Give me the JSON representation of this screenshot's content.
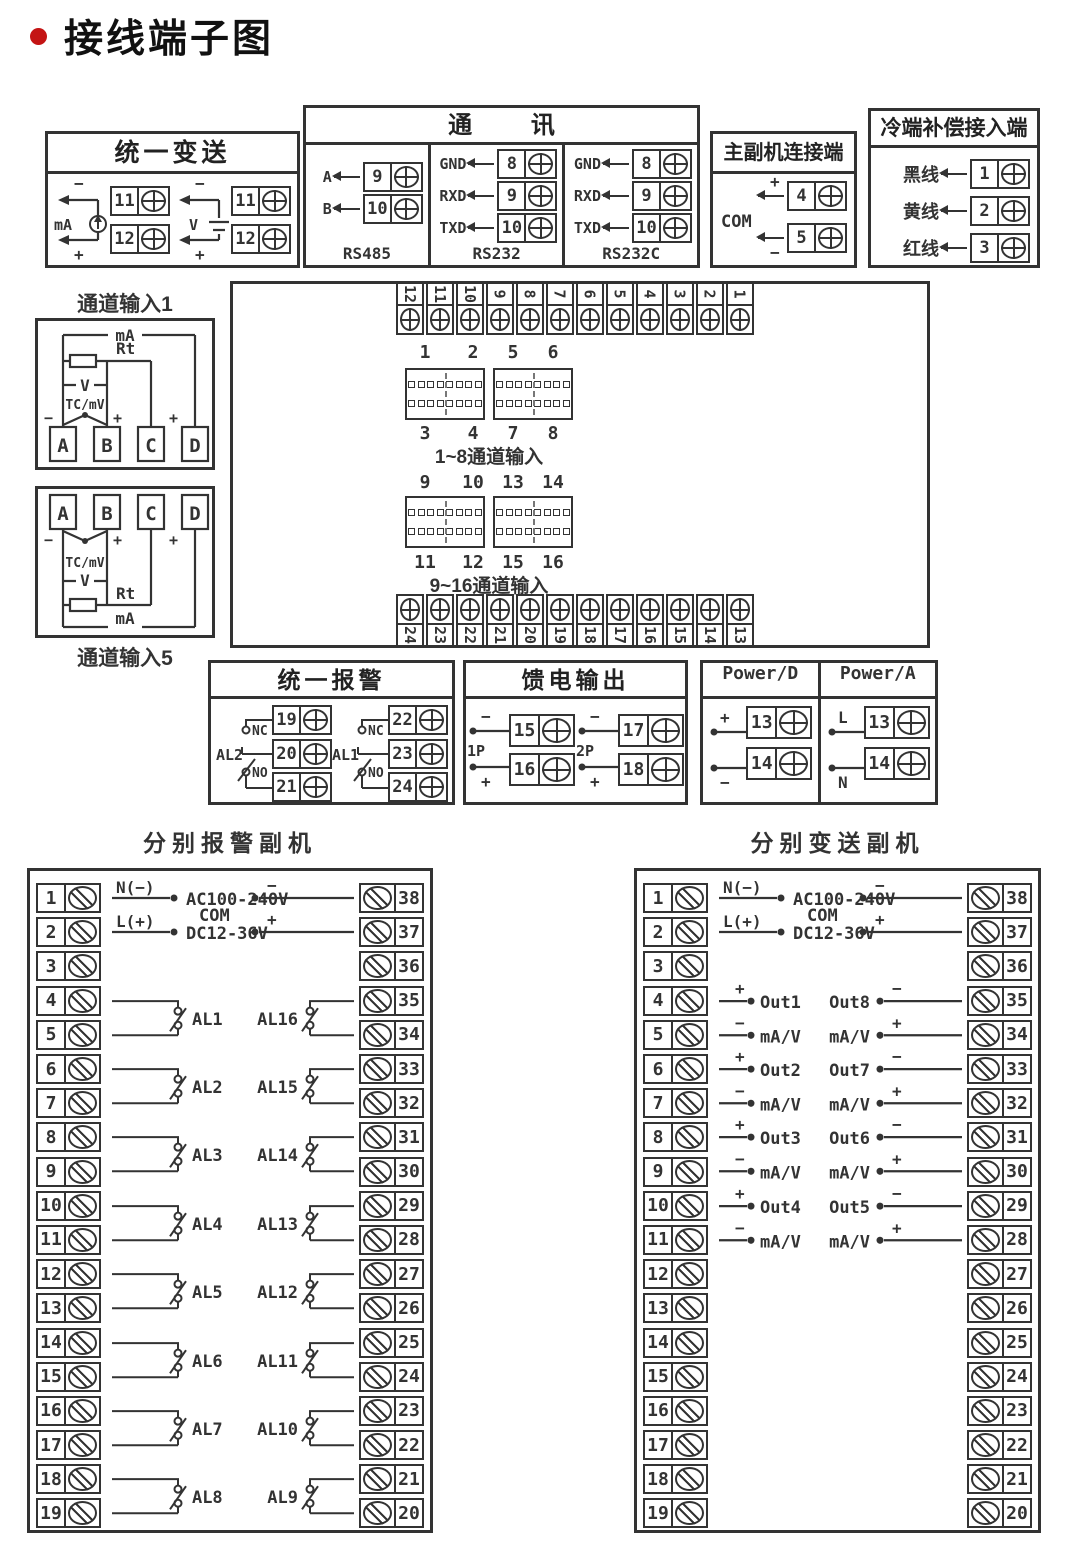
{
  "header": {
    "title": "接线端子图"
  },
  "unified_transmit": {
    "title": "统一变送",
    "groups": [
      {
        "label": "mA",
        "minus": "−",
        "plus": "+",
        "terminals": [
          "11",
          "12"
        ]
      },
      {
        "label": "V",
        "minus": "−",
        "plus": "+",
        "terminals": [
          "11",
          "12"
        ]
      }
    ]
  },
  "comm": {
    "title": "通 讯",
    "columns": [
      {
        "name": "RS485",
        "rows": [
          {
            "label": "A",
            "num": "9"
          },
          {
            "label": "B",
            "num": "10"
          }
        ]
      },
      {
        "name": "RS232",
        "rows": [
          {
            "label": "GND",
            "num": "8"
          },
          {
            "label": "RXD",
            "num": "9"
          },
          {
            "label": "TXD",
            "num": "10"
          }
        ]
      },
      {
        "name": "RS232C",
        "rows": [
          {
            "label": "GND",
            "num": "8"
          },
          {
            "label": "RXD",
            "num": "9"
          },
          {
            "label": "TXD",
            "num": "10"
          }
        ]
      }
    ]
  },
  "master_slave": {
    "title": "主副机连接端",
    "com": "COM",
    "rows": [
      {
        "sign": "+",
        "num": "4"
      },
      {
        "sign": "−",
        "num": "5"
      }
    ]
  },
  "cold_junction": {
    "title": "冷端补偿接入端",
    "rows": [
      {
        "label": "黑线",
        "num": "1"
      },
      {
        "label": "黄线",
        "num": "2"
      },
      {
        "label": "红线",
        "num": "3"
      }
    ]
  },
  "channel_input_1": {
    "title": "通道输入1",
    "ma": "mA",
    "rt": "Rt",
    "v": "V",
    "tc": "TC/mV",
    "minus": "−",
    "plus": "+",
    "terminals": [
      "A",
      "B",
      "C",
      "D"
    ]
  },
  "channel_input_5": {
    "title": "通道输入5",
    "ma": "mA",
    "rt": "Rt",
    "v": "V",
    "tc": "TC/mV",
    "minus": "−",
    "plus": "+",
    "terminals": [
      "A",
      "B",
      "C",
      "D"
    ]
  },
  "main_board": {
    "top_strip": [
      "12",
      "11",
      "10",
      "9",
      "8",
      "7",
      "6",
      "5",
      "4",
      "3",
      "2",
      "1"
    ],
    "bottom_strip": [
      "24",
      "23",
      "22",
      "21",
      "20",
      "19",
      "18",
      "17",
      "16",
      "15",
      "14",
      "13"
    ],
    "group1": {
      "top_labels": [
        "1",
        "2",
        "5",
        "6"
      ],
      "bottom_labels": [
        "3",
        "4",
        "7",
        "8"
      ],
      "caption": "1~8通道输入"
    },
    "group2": {
      "top_labels": [
        "9",
        "10",
        "13",
        "14"
      ],
      "bottom_labels": [
        "11",
        "12",
        "15",
        "16"
      ],
      "caption": "9~16通道输入"
    }
  },
  "unified_alarm": {
    "title": "统一报警",
    "nc": "NC",
    "no": "NO",
    "groups": [
      {
        "name": "AL2",
        "terminals": [
          "19",
          "20",
          "21"
        ]
      },
      {
        "name": "AL1",
        "terminals": [
          "22",
          "23",
          "24"
        ]
      }
    ]
  },
  "feed_output": {
    "title": "馈电输出",
    "minus": "−",
    "plus": "+",
    "groups": [
      {
        "name": "1P",
        "terminals": [
          "15",
          "16"
        ]
      },
      {
        "name": "2P",
        "terminals": [
          "17",
          "18"
        ]
      }
    ]
  },
  "power": {
    "columns": [
      {
        "title": "Power/D",
        "top_sign": "+",
        "bottom_sign": "−",
        "terminals": [
          "13",
          "14"
        ]
      },
      {
        "title": "Power/A",
        "top_sign": "L",
        "bottom_sign": "N",
        "terminals": [
          "13",
          "14"
        ]
      }
    ]
  },
  "alarm_slave": {
    "title": "分别报警副机",
    "power": {
      "n": "N(−)",
      "l": "L(+)",
      "ac": "AC100-240V",
      "dc": "DC12-36V"
    },
    "com": {
      "label": "COM",
      "minus": "−",
      "plus": "+"
    },
    "left_terminals": [
      "1",
      "2",
      "3",
      "4",
      "5",
      "6",
      "7",
      "8",
      "9",
      "10",
      "11",
      "12",
      "13",
      "14",
      "15",
      "16",
      "17",
      "18",
      "19"
    ],
    "right_terminals": [
      "38",
      "37",
      "36",
      "35",
      "34",
      "33",
      "32",
      "31",
      "30",
      "29",
      "28",
      "27",
      "26",
      "25",
      "24",
      "23",
      "22",
      "21",
      "20"
    ],
    "left_relays": [
      "AL1",
      "AL2",
      "AL3",
      "AL4",
      "AL5",
      "AL6",
      "AL7",
      "AL8"
    ],
    "right_relays": [
      "AL16",
      "AL15",
      "AL14",
      "AL13",
      "AL12",
      "AL11",
      "AL10",
      "AL9"
    ]
  },
  "transmit_slave": {
    "title": "分别变送副机",
    "power": {
      "n": "N(−)",
      "l": "L(+)",
      "ac": "AC100-240V",
      "dc": "DC12-36V"
    },
    "com": {
      "label": "COM",
      "minus": "−",
      "plus": "+"
    },
    "plus": "+",
    "minus": "−",
    "left_terminals": [
      "1",
      "2",
      "3",
      "4",
      "5",
      "6",
      "7",
      "8",
      "9",
      "10",
      "11",
      "12",
      "13",
      "14",
      "15",
      "16",
      "17",
      "18",
      "19"
    ],
    "right_terminals": [
      "38",
      "37",
      "36",
      "35",
      "34",
      "33",
      "32",
      "31",
      "30",
      "29",
      "28",
      "27",
      "26",
      "25",
      "24",
      "23",
      "22",
      "21",
      "20"
    ],
    "left_outputs": [
      {
        "name": "Out1",
        "unit": "mA/V"
      },
      {
        "name": "Out2",
        "unit": "mA/V"
      },
      {
        "name": "Out3",
        "unit": "mA/V"
      },
      {
        "name": "Out4",
        "unit": "mA/V"
      }
    ],
    "right_outputs": [
      {
        "name": "Out8",
        "unit": "mA/V"
      },
      {
        "name": "Out7",
        "unit": "mA/V"
      },
      {
        "name": "Out6",
        "unit": "mA/V"
      },
      {
        "name": "Out5",
        "unit": "mA/V"
      }
    ]
  }
}
